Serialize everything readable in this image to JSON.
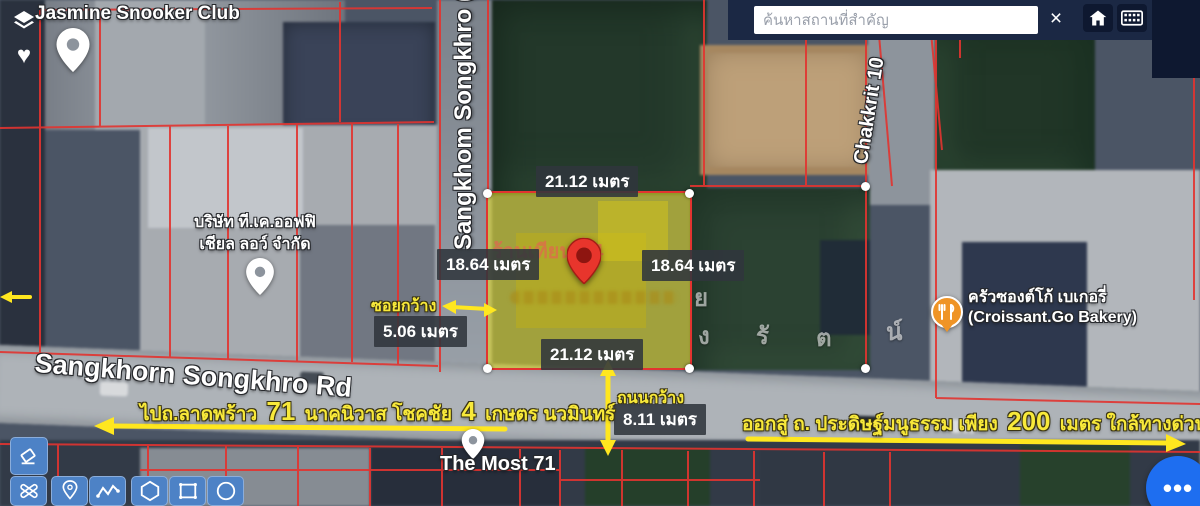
{
  "colors": {
    "toolbar_blue": "#4d82c6",
    "fab_blue": "#1e6ef0",
    "annotation_yellow": "#f8e93a",
    "cadastral_red": "#e23430",
    "parcel_fill": "#e9e01e",
    "badge_bg": "#30353c",
    "topbar_navy": "#1b2844",
    "marker_red": "#e8352c"
  },
  "topbar": {
    "search_placeholder": "ค้นหาสถานที่สำคัญ"
  },
  "icons": {
    "close": "×",
    "heart": "♥",
    "fab_dots": "•••"
  },
  "map_labels": {
    "jasmine_club": "Jasmine Snooker Club",
    "company_line1": "บริษัท ที.เค.ออฟฟิ",
    "company_line2": "เชียล ลอว์ จำกัด",
    "road_vertical_left": "Sangkhom Songkhro (",
    "road_vertical_right": "Chakkrit 10",
    "road_main": "Sangkhorn Songkhro Rd",
    "poi_the_most": "The Most 71",
    "bakery_thai": "ครัวซองต์โก้ เบเกอรี่",
    "bakery_english": "(Croissant.Go Bakery)",
    "parcel_overlay": "ร้านเทียนนี่ 4",
    "big_letters": [
      "ย",
      "ง",
      "รั",
      "ต",
      "น์"
    ]
  },
  "measurements": {
    "width_top": "21.12 เมตร",
    "depth_left": "18.64 เมตร",
    "depth_right": "18.64 เมตร",
    "width_bottom": "21.12 เมตร",
    "alley_label": "ซอยกว้าง",
    "alley_width": "5.06 เมตร",
    "road_label": "ถนนกว้าง",
    "road_width": "8.11 เมตร"
  },
  "routes": {
    "left_pre": "ไปถ.ลาดพร้าว",
    "left_num1": "71",
    "left_mid": "นาคนิวาส โชคชัย",
    "left_num2": "4",
    "left_post": "เกษตร นวมินทร์",
    "right_pre": "ออกสู่ ถ. ประดิษฐ์มนูธรรม เพียง",
    "right_num": "200",
    "right_post": "เมตร ใกล้ทางด่วน"
  }
}
